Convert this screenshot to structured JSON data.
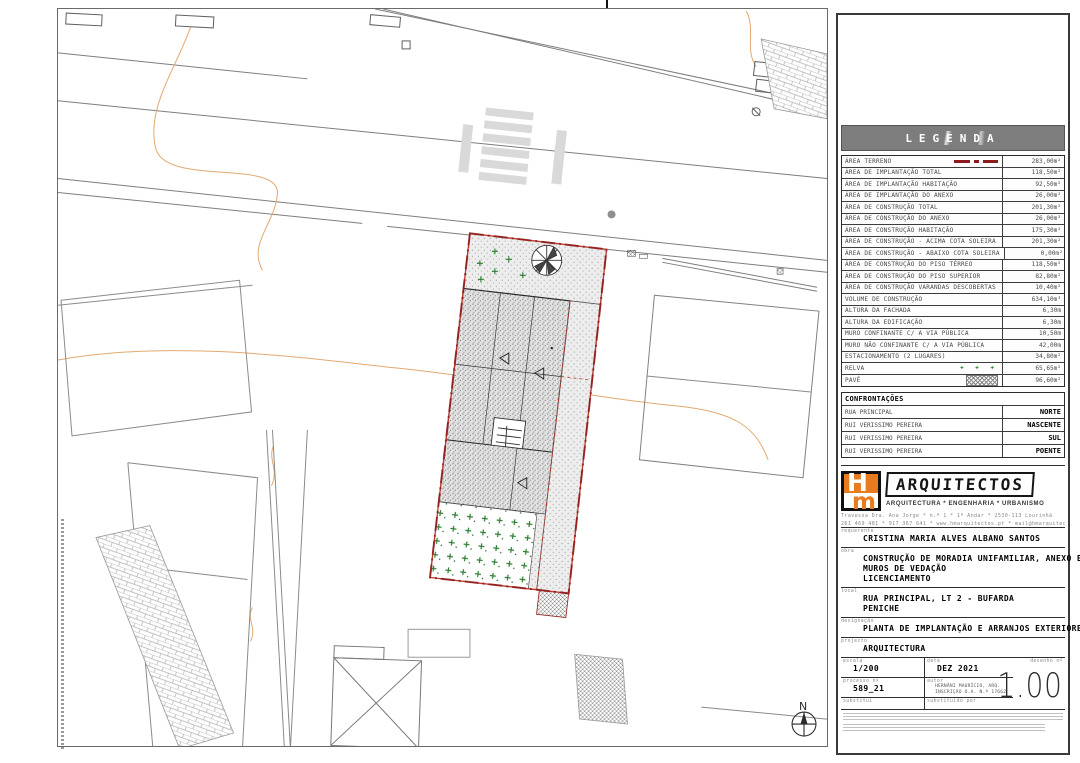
{
  "colors": {
    "plot_boundary_red": "#c0392b",
    "terreno_line_red": "#8e1b1b",
    "relva_green": "#2e7d32",
    "contour_orange": "#e2a96f",
    "logo_orange": "#e87b1e",
    "legend_bar_gray": "#7d7d7d"
  },
  "legend": {
    "title": "LEGENDA",
    "rows": [
      {
        "label": "ÁREA TERRENO",
        "value": "283,00m²",
        "symbol": "terreno"
      },
      {
        "label": "ÁREA DE IMPLANTAÇÃO TOTAL",
        "value": "118,50m²"
      },
      {
        "label": "ÁREA DE IMPLANTAÇÃO HABITAÇÃO",
        "value": "92,50m²"
      },
      {
        "label": "ÁREA DE IMPLANTAÇÃO DO ANEXO",
        "value": "26,00m²"
      },
      {
        "label": "ÁREA DE CONSTRUÇÃO TOTAL",
        "value": "201,30m²"
      },
      {
        "label": "ÁREA DE CONSTRUÇÃO DO ANEXO",
        "value": "26,00m²"
      },
      {
        "label": "ÁREA DE CONSTRUÇÃO HABITAÇÃO",
        "value": "175,30m²"
      },
      {
        "label": "ÁREA DE CONSTRUÇÃO - ACIMA COTA SOLEIRA",
        "value": "201,30m²"
      },
      {
        "label": "ÁREA DE CONSTRUÇÃO - ABAIXO COTA SOLEIRA",
        "value": "0,00m²"
      },
      {
        "label": "ÁREA DE CONSTRUÇÃO DO PISO TÉRREO",
        "value": "118,50m²"
      },
      {
        "label": "ÁREA DE CONSTRUÇÃO DO PISO SUPERIOR",
        "value": "82,80m²"
      },
      {
        "label": "ÁREA DE CONSTRUÇÃO VARANDAS DESCOBERTAS",
        "value": "10,40m²"
      },
      {
        "label": "VOLUME DE CONSTRUÇÃO",
        "value": "634,10m³"
      },
      {
        "label": "ALTURA DA FACHADA",
        "value": "6,30m"
      },
      {
        "label": "ALTURA DA EDIFICAÇÃO",
        "value": "6,30m"
      },
      {
        "label": "MURO CONFINANTE C/ A VIA PÚBLICA",
        "value": "10,50m"
      },
      {
        "label": "MURO NÃO CONFINANTE C/ A VIA PÚBLICA",
        "value": "42,00m"
      },
      {
        "label": "ESTACIONAMENTO (2 LUGARES)",
        "value": "34,80m²"
      },
      {
        "label": "RELVA",
        "value": "65,65m²",
        "symbol": "relva"
      },
      {
        "label": "PAVÊ",
        "value": "96,60m²",
        "symbol": "pave"
      }
    ],
    "confrontacoes": {
      "header": "CONFRONTAÇÕES",
      "rows": [
        {
          "label": "RUA PRINCIPAL",
          "value": "NORTE"
        },
        {
          "label": "RUI VERISSIMO PEREIRA",
          "value": "NASCENTE"
        },
        {
          "label": "RUI VERISSIMO PEREIRA",
          "value": "SUL"
        },
        {
          "label": "RUI VERISSIMO PEREIRA",
          "value": "POENTE"
        }
      ]
    }
  },
  "titleblock": {
    "logo": {
      "monogram_top": "H",
      "monogram_bottom": "m",
      "name": "ARQUITECTOS",
      "tagline": "ARQUITECTURA * ENGENHARIA * URBANISMO",
      "address": "Travessa Dra. Ana Jorge * n.º 1 * 1º Andar * 2530-113 Lourinhã",
      "contacts": "261 469 481 * 917 367 641 * www.hmarquitectos.pt * mail@hmarquitectos.pt"
    },
    "fields": {
      "requerente": {
        "label": "requerente",
        "value": "CRISTINA MARIA ALVES ALBANO SANTOS"
      },
      "obra": {
        "label": "obra",
        "value": "CONSTRUÇÃO DE MORADIA UNIFAMILIAR, ANEXO E",
        "value2": "MUROS DE VEDAÇÃO",
        "value3": "LICENCIAMENTO"
      },
      "local": {
        "label": "local",
        "value": "RUA PRINCIPAL, LT 2 - BUFARDA",
        "value2": "PENICHE"
      },
      "designacao": {
        "label": "designação",
        "value": "PLANTA DE IMPLANTAÇÃO E ARRANJOS EXTERIORES"
      },
      "projecto": {
        "label": "projecto",
        "value": "ARQUITECTURA"
      },
      "escala": {
        "label": "escala",
        "value": "1/200"
      },
      "data": {
        "label": "data",
        "value": "DEZ 2021"
      },
      "desenho": {
        "label": "desenho nº",
        "value": "1.00"
      },
      "processo": {
        "label": "processo nº",
        "value": "589_21"
      },
      "autor": {
        "label": "autor",
        "value": "HERNÂNI MAURÍCIO, ARQ.",
        "value2": "INSCRIÇÃO O.A. N.º 17662"
      },
      "substitui": {
        "label": "substitui"
      },
      "substituido": {
        "label": "substituído por"
      }
    }
  },
  "plan": {
    "north_label": "N"
  }
}
